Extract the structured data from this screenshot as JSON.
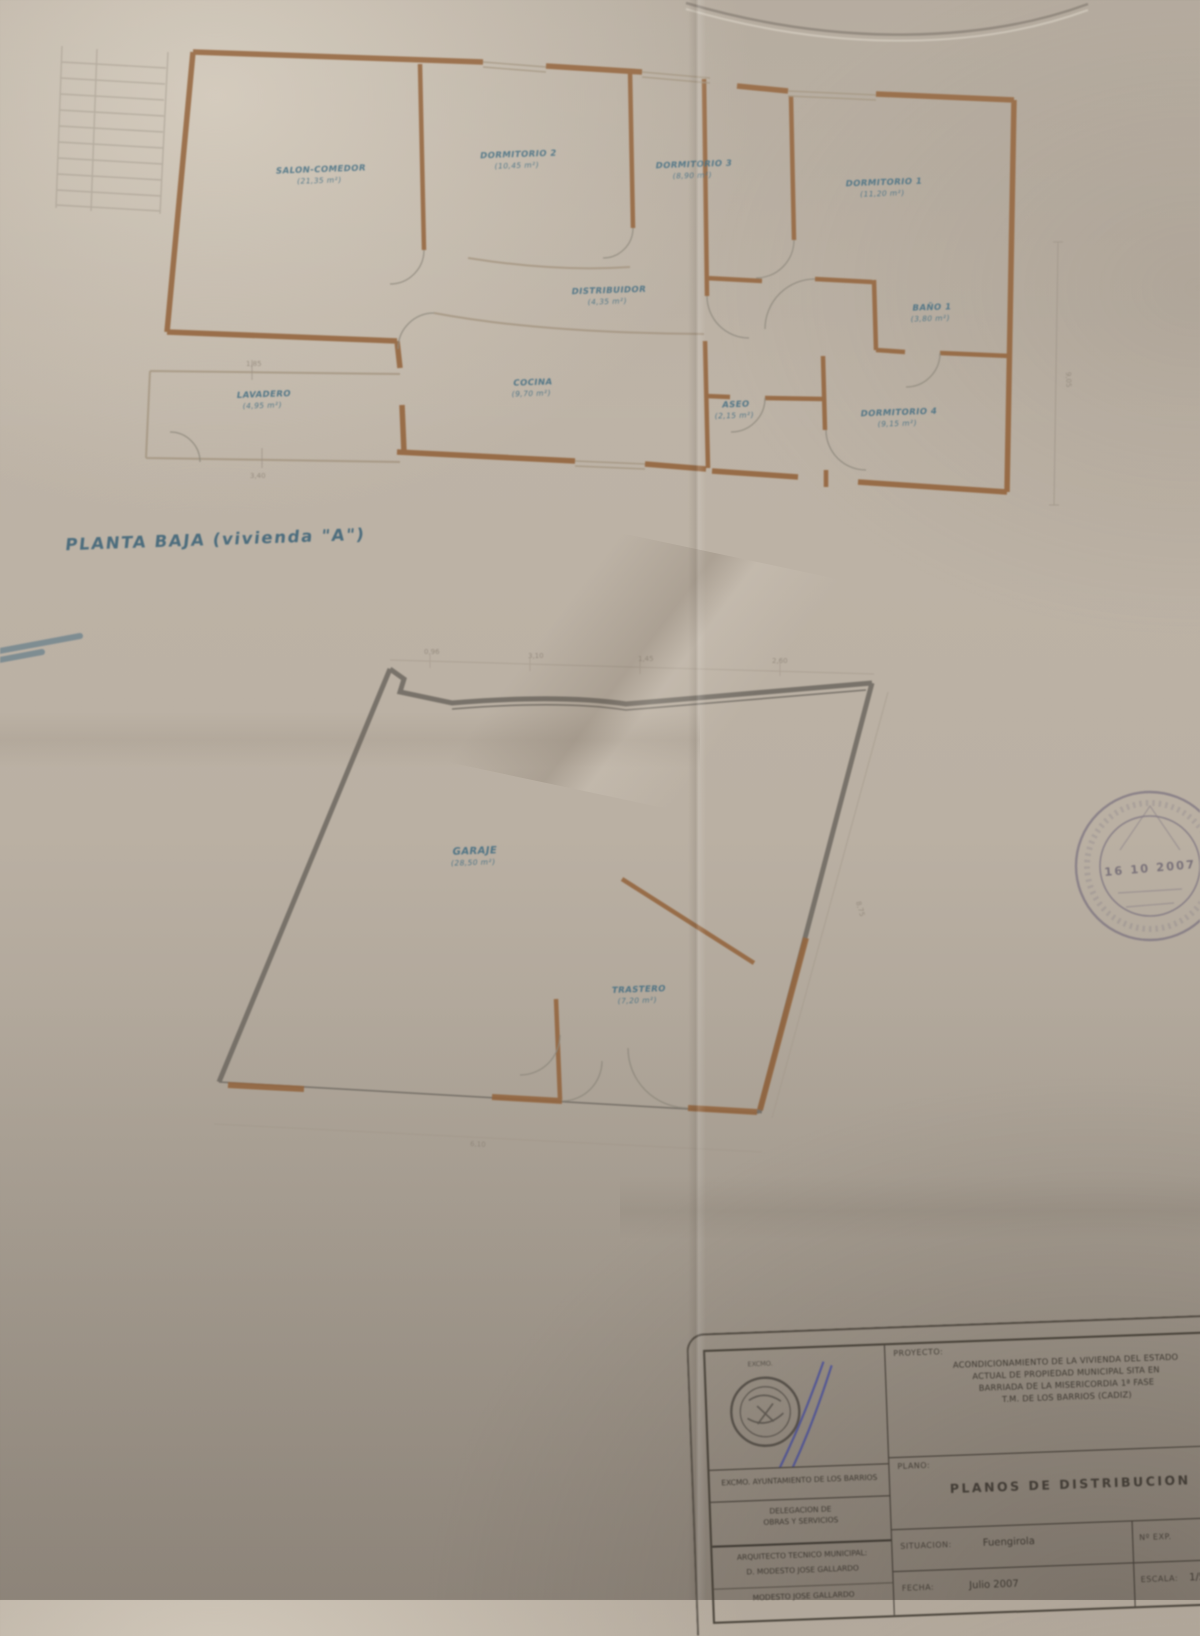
{
  "plan_sheet": {
    "main_title": "PLANTA BAJA (vivienda \"A\")",
    "upper_plan": {
      "rooms": [
        {
          "name": "SALON-COMEDOR",
          "area": "(21,35 m²)"
        },
        {
          "name": "DORMITORIO 2",
          "area": "(10,45 m²)"
        },
        {
          "name": "DORMITORIO 3",
          "area": "(8,90 m²)"
        },
        {
          "name": "DORMITORIO 1",
          "area": "(11,20 m²)"
        },
        {
          "name": "DISTRIBUIDOR",
          "area": "(4,35 m²)"
        },
        {
          "name": "BAÑO 1",
          "area": "(3,80 m²)"
        },
        {
          "name": "LAVADERO",
          "area": "(4,95 m²)"
        },
        {
          "name": "COCINA",
          "area": "(9,70 m²)"
        },
        {
          "name": "ASEO",
          "area": "(2,15 m²)"
        },
        {
          "name": "DORMITORIO 4",
          "area": "(9,15 m²)"
        }
      ],
      "dimensions": [
        "9,05",
        "1,85",
        "3,40"
      ]
    },
    "lower_plan": {
      "rooms": [
        {
          "name": "GARAJE",
          "area": "(28,50 m²)"
        },
        {
          "name": "TRASTERO",
          "area": "(7,20 m²)"
        }
      ],
      "dimensions": [
        "0,96",
        "3,10",
        "1,45",
        "2,60",
        "8,75",
        "6,10"
      ]
    },
    "stamp": {
      "date_line": "16 10 2007"
    },
    "title_block": {
      "proyecto_label": "PROYECTO:",
      "proyecto_line1": "ACONDICIONAMIENTO DE LA VIVIENDA DEL ESTADO",
      "proyecto_line2": "ACTUAL DE PROPIEDAD MUNICIPAL SITA EN",
      "proyecto_line3": "BARRIADA DE LA MISERICORDIA 1ª FASE",
      "proyecto_line4": "T.M. DE LOS BARRIOS (CADIZ)",
      "proyecto_ref": "VILLA",
      "plano_label": "PLANO:",
      "plano_title": "PLANOS DE DISTRIBUCION",
      "situacion_label": "SITUACION:",
      "situacion_value": "Fuengirola",
      "situacion_ref": "Nº EXP.",
      "fecha_label": "FECHA:",
      "fecha_value": "Julio 2007",
      "escala_label": "ESCALA:",
      "escala_value": "1/50",
      "org_line1": "EXCMO. AYUNTAMIENTO DE LOS BARRIOS",
      "deleg_line1": "DELEGACION DE",
      "deleg_line2": "OBRAS Y SERVICIOS",
      "tecnico_label": "ARQUITECTO TECNICO MUNICIPAL:",
      "tecnico_name": "D. MODESTO JOSE GALLARDO",
      "tecnico_name2": "MODESTO JOSE GALLARDO",
      "logo_caption": "EXCMO."
    }
  }
}
